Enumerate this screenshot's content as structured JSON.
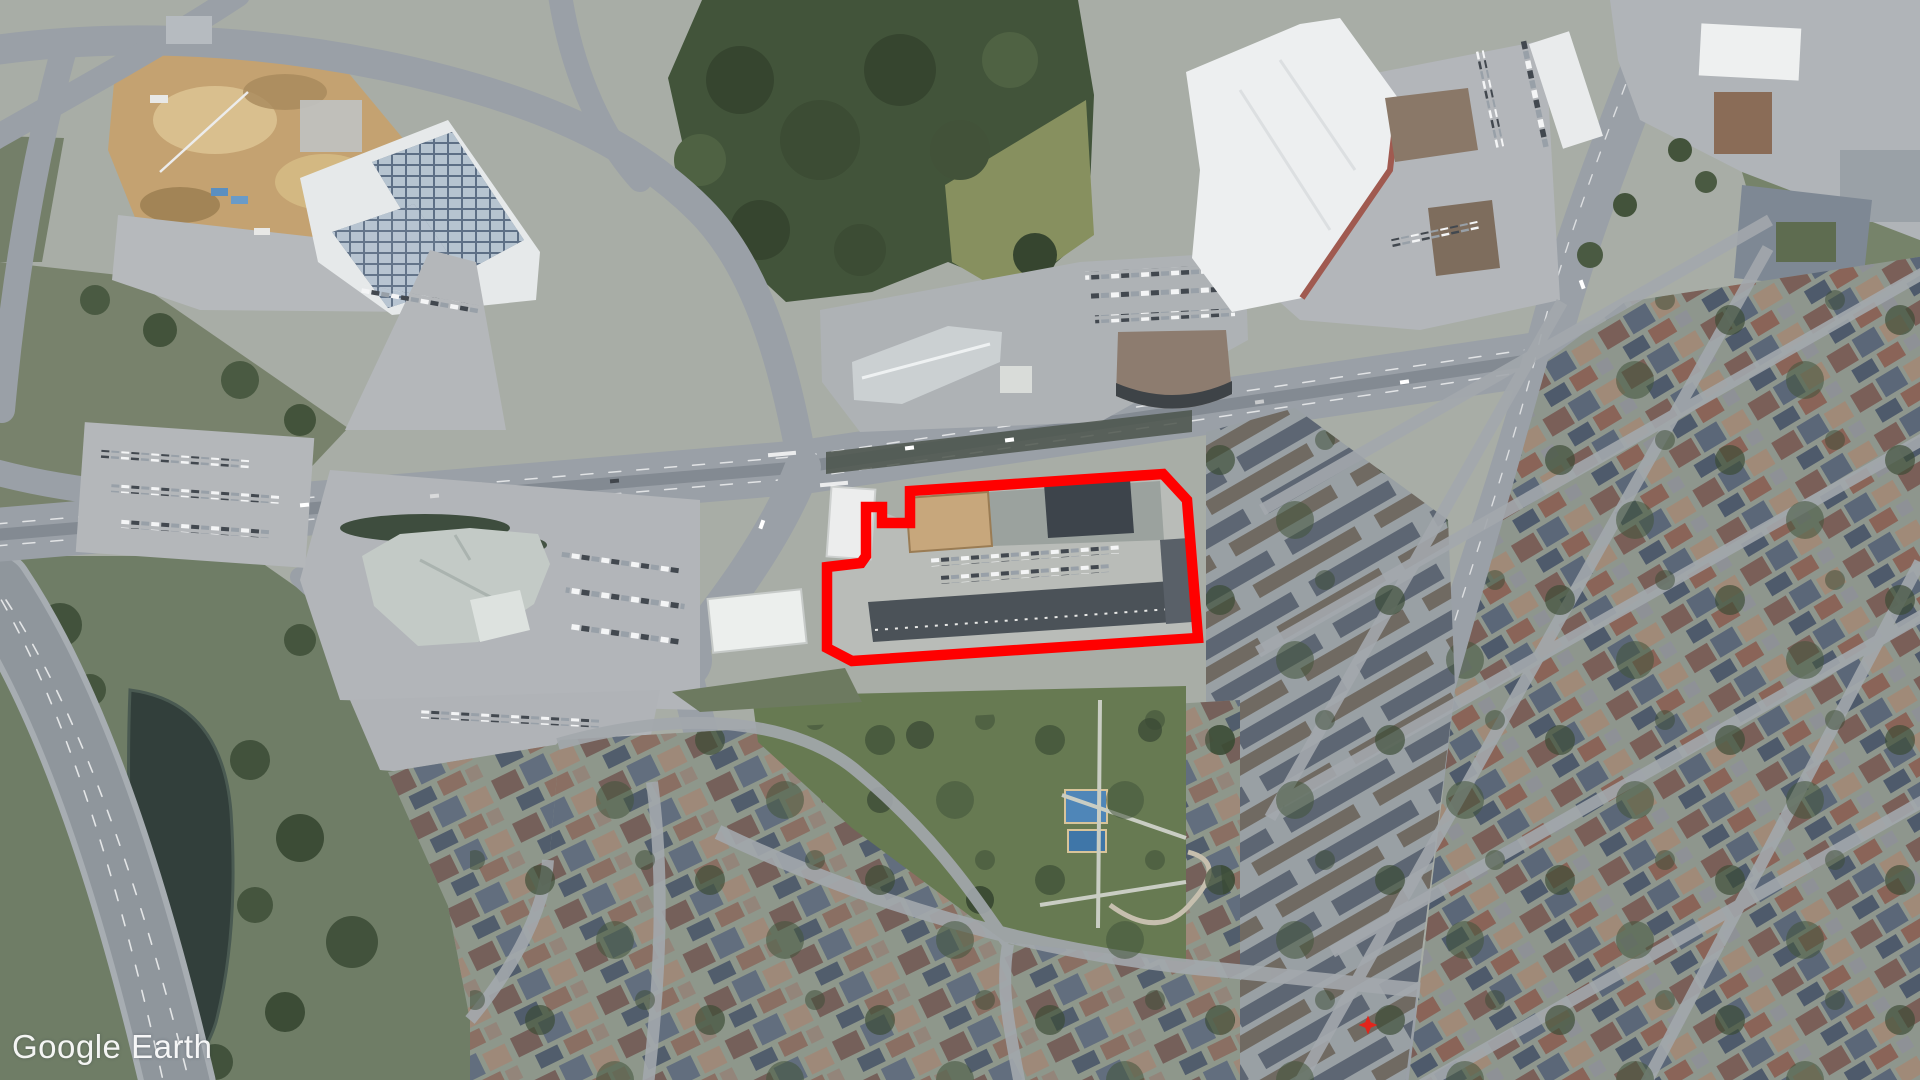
{
  "app": {
    "name": "Google Earth"
  },
  "watermark": {
    "text": "Google Earth",
    "color": "#ffffff"
  },
  "map": {
    "type": "satellite-aerial",
    "description": "Oblique aerial imagery of a suburban intersection: big-box retail and construction at top-left, forest at top-center, Walmart-style plaza top-right, shopping mall left-center, dense residential subdivisions right and bottom, park and pond",
    "overlay": {
      "parcel_outline": {
        "color": "#ff0000",
        "stroke_width": 10.5,
        "points": "827,567 861,563 866,556 866,507 882,507 882,523 910,523 910,491 1163,474 1187,500 1198,638 852,661 827,648"
      },
      "star_marker": {
        "x": 1368,
        "y": 1025,
        "color": "#e1251c"
      }
    },
    "palette": {
      "forest": "#42543a",
      "grass": "#6f7d66",
      "road": "#9aa0a7",
      "parking": "#b4b7bb",
      "roof_white": "#edeff0",
      "roof_dark": "#4b5258",
      "dirt": "#c4a271",
      "water": "#323f3b"
    }
  }
}
